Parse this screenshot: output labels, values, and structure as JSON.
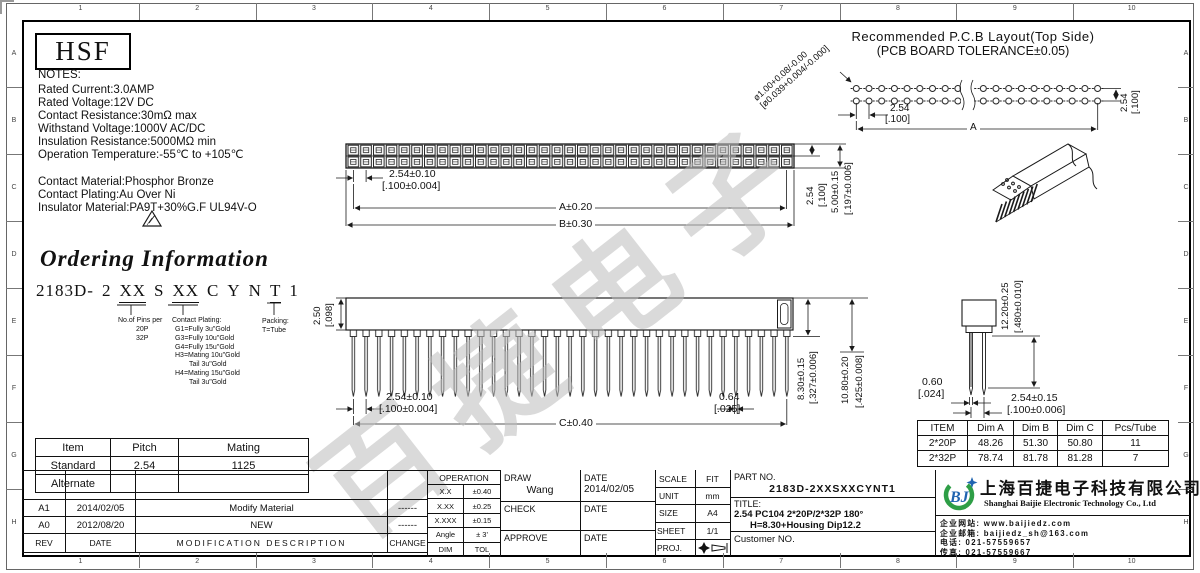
{
  "grid": {
    "cols": [
      "1",
      "2",
      "3",
      "4",
      "5",
      "6",
      "7",
      "8",
      "9",
      "10"
    ],
    "rows": [
      "A",
      "B",
      "C",
      "D",
      "E",
      "F",
      "G",
      "H"
    ]
  },
  "logo_text": "HSF",
  "watermark": "百捷电子",
  "notes": {
    "heading": "NOTES:",
    "lines": [
      "Rated Current:3.0AMP",
      "Rated Voltage:12V DC",
      "Contact Resistance:30mΩ max",
      "Withstand Voltage:1000V AC/DC",
      "Insulation Resistance:5000MΩ min",
      "Operation Temperature:-55℃ to +105℃"
    ],
    "material_lines": [
      "Contact Material:Phosphor Bronze",
      "Contact Plating:Au Over Ni",
      "Insulator Material:PA9T+30%G.F UL94V-O"
    ]
  },
  "pcb_layout": {
    "title_line1": "Recommended P.C.B Layout(Top Side)",
    "title_line2": "(PCB BOARD TOLERANCE±0.05)",
    "hole_dia_mm": "ø1.00+0.08/-0.00",
    "hole_dia_in": "[ø0.039+0.004/-0.000]",
    "pitch_mm": "2.54",
    "pitch_in": "[.100]",
    "dim_a": "A",
    "row_pitch_mm": "2.54",
    "row_pitch_in": "[.100]"
  },
  "top_view": {
    "pitch_mm": "2.54±0.10",
    "pitch_in": "[.100±0.004]",
    "dim_a": "A±0.20",
    "dim_b": "B±0.30",
    "row_pitch_mm": "2.54",
    "row_pitch_in": "[.100]",
    "width_mm": "5.00±0.15",
    "width_in": "[.197±0.006]"
  },
  "front_view": {
    "top_h_mm": "2.50",
    "top_h_in": "[.098]",
    "pitch_mm": "2.54±0.10",
    "pitch_in": "[.100±0.004]",
    "pin_w_mm": "0.64",
    "pin_w_in": "[.025]",
    "dim_c": "C±0.40",
    "pin_len_mm": "8.30±0.15",
    "pin_len_in": "[.327±0.006]",
    "total_h_mm": "10.80±0.20",
    "total_h_in": "[.425±0.008]"
  },
  "side_view": {
    "body_h_mm": "12.20±0.25",
    "body_h_in": "[.480±0.010]",
    "pin_t_mm": "0.60",
    "pin_t_in": "[.024]",
    "pitch_mm": "2.54±0.15",
    "pitch_in": "[.100±0.006]"
  },
  "ordering": {
    "title": "Ordering Information",
    "pn_segments": [
      {
        "t": "2183D-"
      },
      {
        "t": "2"
      },
      {
        "t": "XX",
        "u": true
      },
      {
        "t": "S"
      },
      {
        "t": "XX",
        "u": true
      },
      {
        "t": "C"
      },
      {
        "t": "Y"
      },
      {
        "t": "N"
      },
      {
        "t": "T",
        "u": true
      },
      {
        "t": "1"
      }
    ],
    "pins_label": "No.of Pins per",
    "pins_options": [
      "20P",
      "32P"
    ],
    "plating_label": "Contact Plating:",
    "plating_options": [
      "G1=Fully 3u\"Gold",
      "G3=Fully 10u\"Gold",
      "G4=Fully 15u\"Gold",
      "H3=Mating 10u\"Gold",
      "Tail 3u\"Gold",
      "H4=Mating 15u\"Gold",
      "Tail 3u\"Gold"
    ],
    "packing_label": "Packing:",
    "packing_options": [
      "T=Tube"
    ]
  },
  "mating_table": {
    "headers": [
      "Item",
      "Pitch",
      "Mating"
    ],
    "rows": [
      [
        "Standard",
        "2.54",
        "1125"
      ],
      [
        "Alternate",
        "",
        ""
      ]
    ]
  },
  "dim_table": {
    "headers": [
      "ITEM",
      "Dim A",
      "Dim B",
      "Dim C",
      "Pcs/Tube"
    ],
    "rows": [
      [
        "2*20P",
        "48.26",
        "51.30",
        "50.80",
        "11"
      ],
      [
        "2*32P",
        "78.74",
        "81.78",
        "81.28",
        "7"
      ]
    ]
  },
  "revisions": {
    "headers": [
      "REV",
      "DATE",
      "MODIFICATION DESCRIPTION",
      "CHANGE"
    ],
    "rows": [
      [
        "A1",
        "2014/02/05",
        "Modify Material",
        "------"
      ],
      [
        "A0",
        "2012/08/20",
        "NEW",
        "------"
      ]
    ]
  },
  "tolerances": {
    "header": "OPERATION",
    "rows": [
      [
        "X.X",
        "±0.40"
      ],
      [
        "X.XX",
        "±0.25"
      ],
      [
        "X.XXX",
        "±0.15"
      ],
      [
        "Angle",
        "± 3'"
      ],
      [
        "DIM",
        "TOL"
      ]
    ]
  },
  "approval": {
    "draw_label": "DRAW",
    "draw_name": "Wang",
    "date_label": "DATE",
    "draw_date": "2014/02/05",
    "check_label": "CHECK",
    "approve_label": "APPROVE"
  },
  "sheet_info": {
    "scale_label": "SCALE",
    "scale": "FIT",
    "unit_label": "UNIT",
    "unit": "mm",
    "size_label": "SIZE",
    "size": "A4",
    "sheet_label": "SHEET",
    "sheet": "1/1",
    "proj_label": "PROJ."
  },
  "part_info": {
    "part_no_label": "PART NO.",
    "part_no": "2183D-2XXSXXCYNT1",
    "title_label": "TITLE:",
    "title_line1": "2.54 PC104 2*20P/2*32P 180°",
    "title_line2": "H=8.30+Housing Dip12.2",
    "customer_label": "Customer NO."
  },
  "company": {
    "logo_text": "BJ",
    "name_cn": "上海百捷电子科技有限公司",
    "name_en": "Shanghai Baijie Electronic Technology Co., Ltd",
    "website": "企业网站: www.baijiedz.com",
    "email": "企业邮箱: baijiedz_sh@163.com",
    "phone": "电话: 021-57559657",
    "fax": "传真: 021-57559667",
    "logo_green": "#2e9e46",
    "logo_blue": "#1f63b0"
  }
}
